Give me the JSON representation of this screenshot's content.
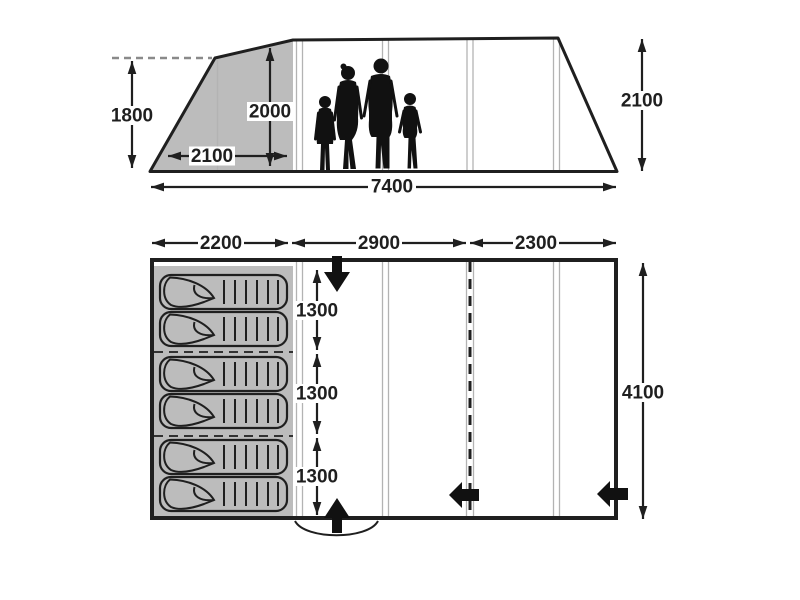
{
  "colors": {
    "line": "#1f1f1f",
    "shade": "#bcbcbc",
    "pole_line": "#b3b3b3",
    "dashed_guide": "#8a8a8a",
    "silhouette": "#111111"
  },
  "side_view": {
    "left_height_mm": "1800",
    "standing_height_mm": "2000",
    "front_section_width_mm": "2100",
    "total_length_mm": "7400",
    "right_height_mm": "2100"
  },
  "floor_plan": {
    "section_widths_mm": [
      "2200",
      "2900",
      "2300"
    ],
    "bed_widths_mm": [
      "1300",
      "1300",
      "1300"
    ],
    "total_depth_mm": "4100",
    "sleeping_bag_count": 6
  }
}
